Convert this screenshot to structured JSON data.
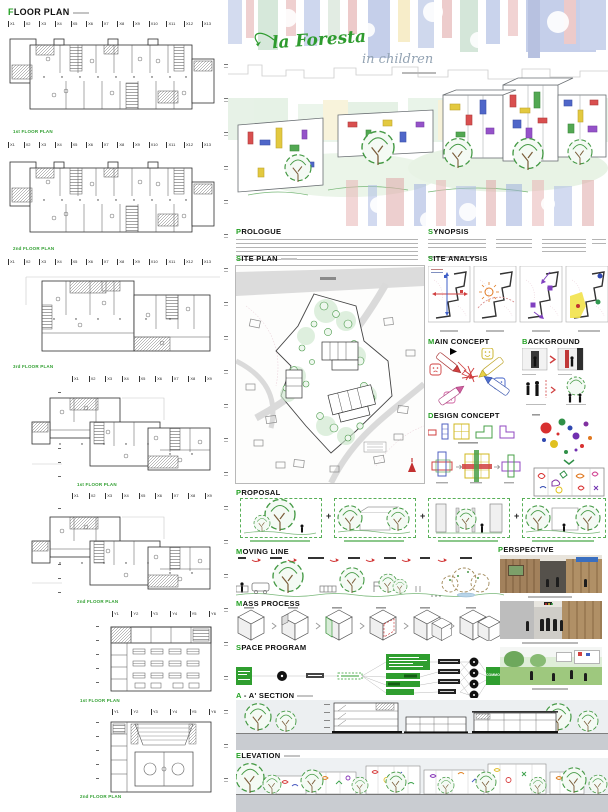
{
  "palette": {
    "accent_green": "#23a123",
    "label_green": "#2f9e2f",
    "arrow_red": "#d03030",
    "ground_gray": "#c9ccd1",
    "band_bg": "#eceff1"
  },
  "left": {
    "title": "FLOOR PLAN",
    "grids": {
      "x13": [
        "X1",
        "X2",
        "X3",
        "X4",
        "X5",
        "X6",
        "X7",
        "X8",
        "X9",
        "X10",
        "X11",
        "X12",
        "X13"
      ],
      "x9": [
        "X1",
        "X2",
        "X3",
        "X4",
        "X5",
        "X6",
        "X7",
        "X8",
        "X9"
      ],
      "y6": [
        "Y1",
        "Y2",
        "Y3",
        "Y4",
        "Y5",
        "Y6"
      ]
    },
    "plan_labels": [
      "1st FLOOR PLAN",
      "2nd FLOOR PLAN",
      "3rd FLOOR PLAN",
      "1st FLOOR PLAN",
      "2nd FLOOR PLAN",
      "1st FLOOR PLAN",
      "2nd FLOOR PLAN"
    ]
  },
  "hero": {
    "title": "la Foresta",
    "subtitle": "in children"
  },
  "sections": {
    "prologue": "PROLOGUE",
    "synopsis": "SYNOPSIS",
    "site_plan": "SITE PLAN",
    "site_analysis": "SITE ANALYSIS",
    "main_concept": "MAIN CONCEPT",
    "background": "BACKGROUND",
    "design_concept": "DESIGN CONCEPT",
    "proposal": "PROPOSAL",
    "moving_line": "MOVING LINE",
    "mass_process": "MASS PROCESS",
    "space_program": "SPACE PROGRAM",
    "perspective": "PERSPECTIVE",
    "section_aa": "A - A' SECTION",
    "elevation": "ELEVATION"
  },
  "proposal": {
    "plus": "+"
  },
  "space_program": {
    "common_label": "COMMON"
  }
}
